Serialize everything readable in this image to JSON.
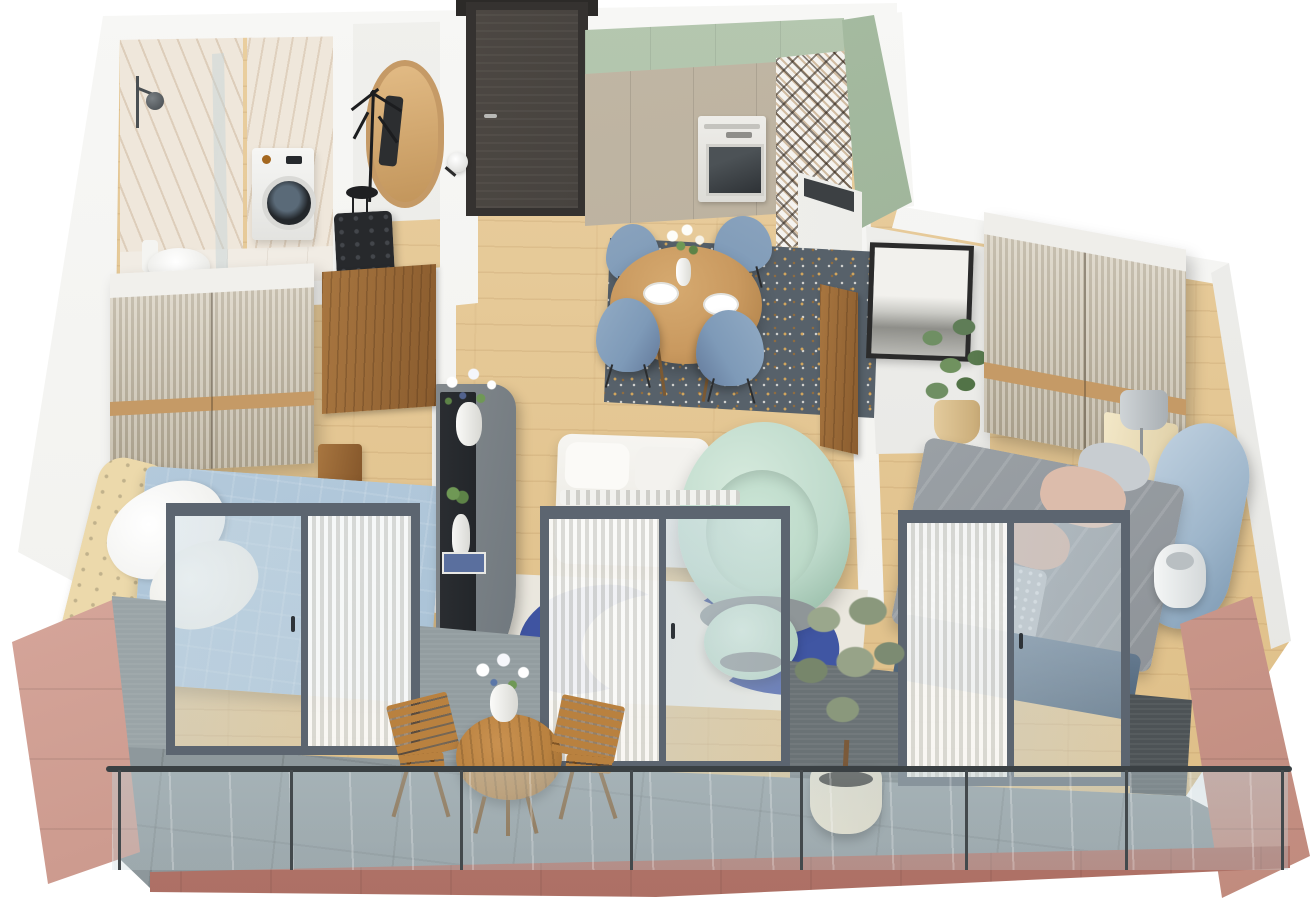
{
  "scene": {
    "title": "3D isometric floor plan of a two-bedroom apartment with balcony",
    "view": "isometric cutaway render",
    "width_px": 1313,
    "height_px": 900
  },
  "palette": {
    "bg": "#ffffff",
    "wall": "#f0f0ed",
    "wall_shade": "#e4e4e1",
    "wood": "#eacfa0",
    "wood_dark": "#ddbd85",
    "marble": "#efe7db",
    "walnut": "#8a5c2e",
    "entry_door": "#47433f",
    "frame_dark": "#2c2a28",
    "sage": "#a9bda4",
    "sage_dark": "#92a98e",
    "greige": "#b2a794",
    "terrazzo": "#57616a",
    "fleck_gold": "#d8a95d",
    "oak": "#c9995f",
    "chair_blue": "#7e9ab8",
    "rug_cream": "#eae7de",
    "rug_blue": "#3f54a1",
    "mint": "#bedacb",
    "console": "#6f777d",
    "tv": "#23262a",
    "bed_blue": "#a9c2d6",
    "cream_tuft": "#ecd9ab",
    "duvet_gray": "#8f9499",
    "blush": "#dcbcab",
    "headboard_blue": "#9db5ca",
    "flute_light": "#d5cdbc",
    "flute_dark": "#b3a994",
    "wood_stripe": "#c59a66",
    "knee": "#9aa4a7",
    "knee_dark": "#4d5356",
    "balcony_tile": "#8d979b",
    "rail": "#3a4043",
    "fascia": "#bf837a",
    "rose": "#e5bab0",
    "rose_deep": "#c08a7d",
    "out_wood": "#b9813f",
    "olive": "#8a987c",
    "pot": "#e7ddc5",
    "lamp": "#c3c8cb",
    "door_frame": "#5c6570",
    "glass_tint": "rgba(193,209,214,0.42)"
  },
  "rooms": {
    "bathroom": {
      "label": "bathroom",
      "items": [
        "marble shower walls",
        "glass shower screen",
        "rain shower",
        "toilet",
        "washing machine",
        "white vanity"
      ]
    },
    "hallway": {
      "label": "entry hallway",
      "items": [
        "dark entry door",
        "oval wood mirror",
        "black coat stand",
        "black tufted bench",
        "globe wall sconce"
      ]
    },
    "kitchen": {
      "label": "kitchen",
      "items": [
        "sage upper cabinets",
        "greige tall cabinets",
        "built-in oven",
        "geometric tile backsplash",
        "peninsula counter with sink",
        "sage base cabinet"
      ]
    },
    "dining": {
      "label": "dining area",
      "items": [
        "round oak table",
        "4 blue armchairs",
        "tulip vase",
        "2 place settings",
        "terrazzo rug"
      ]
    },
    "living": {
      "label": "living area",
      "items": [
        "curved gray tv console",
        "tv",
        "bouquet vase",
        "white figurine",
        "books",
        "cream and blue rug",
        "mint curved sofa",
        "mint ottoman",
        "white sofa"
      ]
    },
    "bedroom_left": {
      "label": "bedroom 1",
      "items": [
        "fluted wardrobe",
        "open walnut door",
        "bed with light blue duvet",
        "cream tufted headboard",
        "white pillows",
        "wood side table"
      ]
    },
    "bedroom_right": {
      "label": "bedroom 2",
      "items": [
        "fluted wardrobe",
        "open walnut door",
        "framed art print",
        "potted ficus",
        "bed with gray duvet",
        "blue curved headboard",
        "blush pillows",
        "knit throw",
        "cream nightstand",
        "table lamp",
        "floor lamp"
      ]
    },
    "balcony": {
      "label": "balcony",
      "items": [
        "gray tile floor",
        "glass railing with posts",
        "rose facade walls",
        "folding bistro table",
        "2 wooden folding chairs",
        "flower vase",
        "olive tree in cream pot"
      ]
    }
  },
  "counts": {
    "rooms": 8,
    "balcony_doors": 3,
    "dining_chairs": 4,
    "railing_posts": 8
  }
}
